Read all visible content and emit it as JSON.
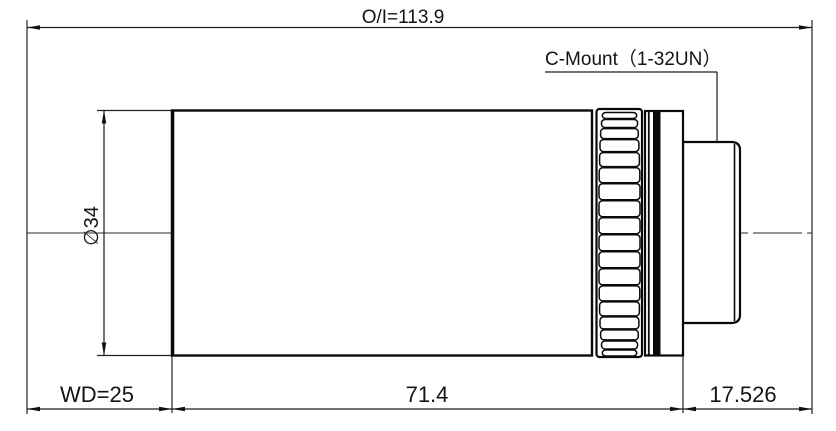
{
  "drawing": {
    "overall_dimension": "O/I=113.9",
    "mount_label": "C-Mount（1-32UN）",
    "diameter_label": "∅34",
    "working_distance_label": "WD=25",
    "body_length_label": "71.4",
    "flange_distance_label": "17.526",
    "line_color": "#141414",
    "background_color": "#ffffff"
  }
}
